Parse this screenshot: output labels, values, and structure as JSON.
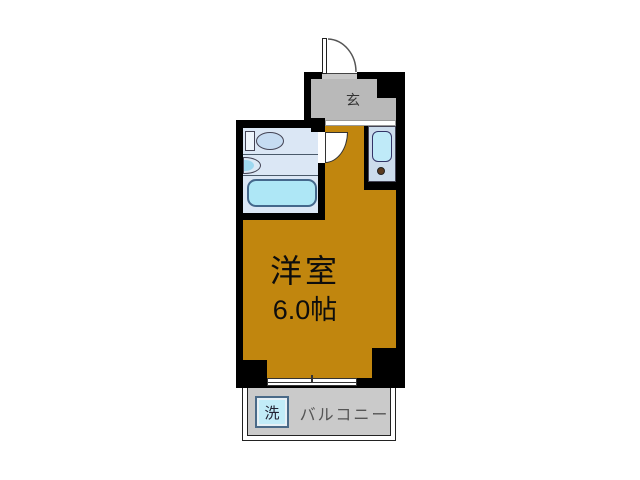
{
  "floor_plan": {
    "type": "studio-apartment-floor-plan",
    "entrance": {
      "label": "玄"
    },
    "main_room": {
      "name": "洋室",
      "size": "6.0帖"
    },
    "balcony": {
      "label": "バルコニー"
    },
    "washing_machine": {
      "label": "洗"
    }
  },
  "colors": {
    "wall": "#000000",
    "room_floor": "#c1860e",
    "entrance_floor": "#b9b9b9",
    "balcony_floor": "#cacaca",
    "bathroom_floor": "#dbe7f5",
    "bathtub": "#aee7f6",
    "kitchen_counter": "#ccdcec",
    "kitchen_sink": "#bfeaf8",
    "washer_fill": "#c2ecf8",
    "burner": "#5c3a1e"
  }
}
